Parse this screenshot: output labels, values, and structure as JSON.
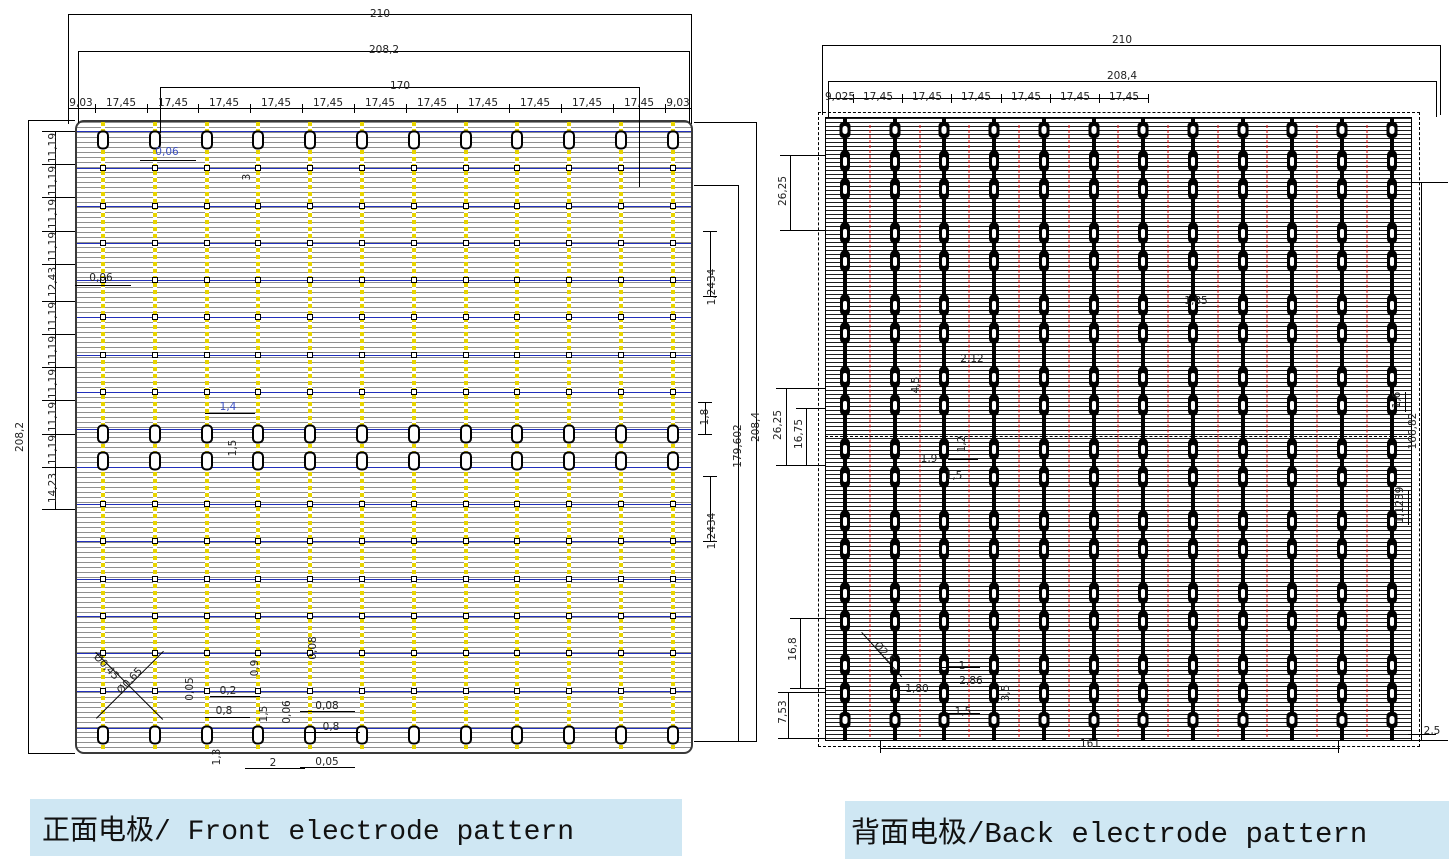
{
  "colors": {
    "caption_bg": "#cfe7f3",
    "front_finger_gray": "#8f8f8f",
    "front_busbar_yellow": "#e8d400",
    "front_interconnect_blue": "#2230bb",
    "back_finger_black": "#1c1c1c",
    "back_center_red": "#e00000",
    "dim_text_blue": "#3b4fc0"
  },
  "panels": [
    {
      "caption": "正面电极/ Front electrode pattern",
      "dims": [
        {
          "t": "210",
          "x": 380,
          "y": 14
        },
        {
          "t": "208,2",
          "x": 384,
          "y": 50
        },
        {
          "t": "170",
          "x": 400,
          "y": 86
        },
        {
          "t": "9,03",
          "x": 81,
          "y": 103
        },
        {
          "t": "17,45",
          "x": 121,
          "y": 103
        },
        {
          "t": "17,45",
          "x": 173,
          "y": 103
        },
        {
          "t": "17,45",
          "x": 224,
          "y": 103
        },
        {
          "t": "17,45",
          "x": 276,
          "y": 103
        },
        {
          "t": "17,45",
          "x": 328,
          "y": 103
        },
        {
          "t": "17,45",
          "x": 380,
          "y": 103
        },
        {
          "t": "17,45",
          "x": 432,
          "y": 103
        },
        {
          "t": "17,45",
          "x": 483,
          "y": 103
        },
        {
          "t": "17,45",
          "x": 535,
          "y": 103
        },
        {
          "t": "17,45",
          "x": 587,
          "y": 103
        },
        {
          "t": "17,45",
          "x": 639,
          "y": 103
        },
        {
          "t": "9,03",
          "x": 678,
          "y": 103
        },
        {
          "t": "11,19",
          "x": 53,
          "y": 148,
          "r": -90
        },
        {
          "t": "11,19",
          "x": 53,
          "y": 181,
          "r": -90
        },
        {
          "t": "11,19",
          "x": 53,
          "y": 214,
          "r": -90
        },
        {
          "t": "11,19",
          "x": 53,
          "y": 247,
          "r": -90
        },
        {
          "t": "12,43",
          "x": 53,
          "y": 282,
          "r": -90
        },
        {
          "t": "11,19",
          "x": 53,
          "y": 317,
          "r": -90
        },
        {
          "t": "11,19",
          "x": 53,
          "y": 351,
          "r": -90
        },
        {
          "t": "11,19",
          "x": 53,
          "y": 384,
          "r": -90
        },
        {
          "t": "11,19",
          "x": 53,
          "y": 417,
          "r": -90
        },
        {
          "t": "11,19",
          "x": 53,
          "y": 450,
          "r": -90
        },
        {
          "t": "14,23",
          "x": 53,
          "y": 488,
          "r": -90
        },
        {
          "t": "208,2",
          "x": 20,
          "y": 437,
          "r": -90
        },
        {
          "t": "1,2434",
          "x": 712,
          "y": 287,
          "r": -90
        },
        {
          "t": "1,8",
          "x": 705,
          "y": 417,
          "r": -90
        },
        {
          "t": "1,2434",
          "x": 712,
          "y": 531,
          "r": -90
        },
        {
          "t": "179,602",
          "x": 738,
          "y": 446,
          "r": -90
        },
        {
          "t": "208,4",
          "x": 756,
          "y": 427,
          "r": -90
        },
        {
          "t": "0,06",
          "x": 167,
          "y": 152,
          "c": "blue"
        },
        {
          "t": "3",
          "x": 247,
          "y": 177,
          "r": -90
        },
        {
          "t": "0,06",
          "x": 101,
          "y": 278
        },
        {
          "t": "1,4",
          "x": 228,
          "y": 407,
          "c": "blue"
        },
        {
          "t": "1,5",
          "x": 233,
          "y": 448,
          "r": -90
        },
        {
          "t": "0,05",
          "x": 190,
          "y": 689,
          "r": -90
        },
        {
          "t": "0,2",
          "x": 228,
          "y": 691
        },
        {
          "t": "0,8",
          "x": 224,
          "y": 711
        },
        {
          "t": "0,08",
          "x": 313,
          "y": 648,
          "r": -90
        },
        {
          "t": "0,9",
          "x": 255,
          "y": 668,
          "r": -90
        },
        {
          "t": "1,5",
          "x": 264,
          "y": 714,
          "r": -90
        },
        {
          "t": "0,06",
          "x": 287,
          "y": 712,
          "r": -90
        },
        {
          "t": "0,08",
          "x": 327,
          "y": 706
        },
        {
          "t": "0,8",
          "x": 331,
          "y": 727
        },
        {
          "t": "1,3",
          "x": 217,
          "y": 757,
          "r": -90
        },
        {
          "t": "2",
          "x": 273,
          "y": 763
        },
        {
          "t": "0,05",
          "x": 327,
          "y": 762
        },
        {
          "t": "Ø0,45",
          "x": 106,
          "y": 667,
          "r": 47
        },
        {
          "t": "Ø0,65",
          "x": 130,
          "y": 681,
          "r": -47
        }
      ]
    },
    {
      "caption": "背面电极/Back electrode pattern",
      "dims": [
        {
          "t": "210",
          "x": 1122,
          "y": 40
        },
        {
          "t": "208,4",
          "x": 1122,
          "y": 76
        },
        {
          "t": "9,025",
          "x": 840,
          "y": 97
        },
        {
          "t": "17,45",
          "x": 878,
          "y": 97
        },
        {
          "t": "17,45",
          "x": 927,
          "y": 97
        },
        {
          "t": "17,45",
          "x": 976,
          "y": 97
        },
        {
          "t": "17,45",
          "x": 1026,
          "y": 97
        },
        {
          "t": "17,45",
          "x": 1075,
          "y": 97
        },
        {
          "t": "17,45",
          "x": 1124,
          "y": 97
        },
        {
          "t": "26,25",
          "x": 783,
          "y": 191,
          "r": -90
        },
        {
          "t": "26,25",
          "x": 778,
          "y": 425,
          "r": -90
        },
        {
          "t": "16,75",
          "x": 799,
          "y": 434,
          "r": -90
        },
        {
          "t": "16,8",
          "x": 793,
          "y": 649,
          "r": -90
        },
        {
          "t": "7,53",
          "x": 783,
          "y": 712,
          "r": -90
        },
        {
          "t": "1,6",
          "x": 1397,
          "y": 400,
          "r": -90
        },
        {
          "t": "166,82",
          "x": 1413,
          "y": 431,
          "r": -90
        },
        {
          "t": "1,1239",
          "x": 1400,
          "y": 505,
          "r": -90
        },
        {
          "t": "1,85",
          "x": 1196,
          "y": 301
        },
        {
          "t": "2,12",
          "x": 972,
          "y": 359
        },
        {
          "t": "4,5",
          "x": 916,
          "y": 385,
          "r": -90
        },
        {
          "t": "1,2",
          "x": 962,
          "y": 444,
          "r": -90
        },
        {
          "t": "1,9",
          "x": 929,
          "y": 459
        },
        {
          "t": "1,5",
          "x": 954,
          "y": 476
        },
        {
          "t": "Ø2,5",
          "x": 884,
          "y": 653,
          "r": 48
        },
        {
          "t": "1",
          "x": 962,
          "y": 666
        },
        {
          "t": "2,86",
          "x": 971,
          "y": 681
        },
        {
          "t": "1,80",
          "x": 917,
          "y": 689
        },
        {
          "t": "3,5",
          "x": 1006,
          "y": 693,
          "r": -90
        },
        {
          "t": "1,5",
          "x": 963,
          "y": 712
        },
        {
          "t": "161",
          "x": 1090,
          "y": 744
        },
        {
          "t": "2,5",
          "x": 1432,
          "y": 731
        }
      ]
    }
  ]
}
